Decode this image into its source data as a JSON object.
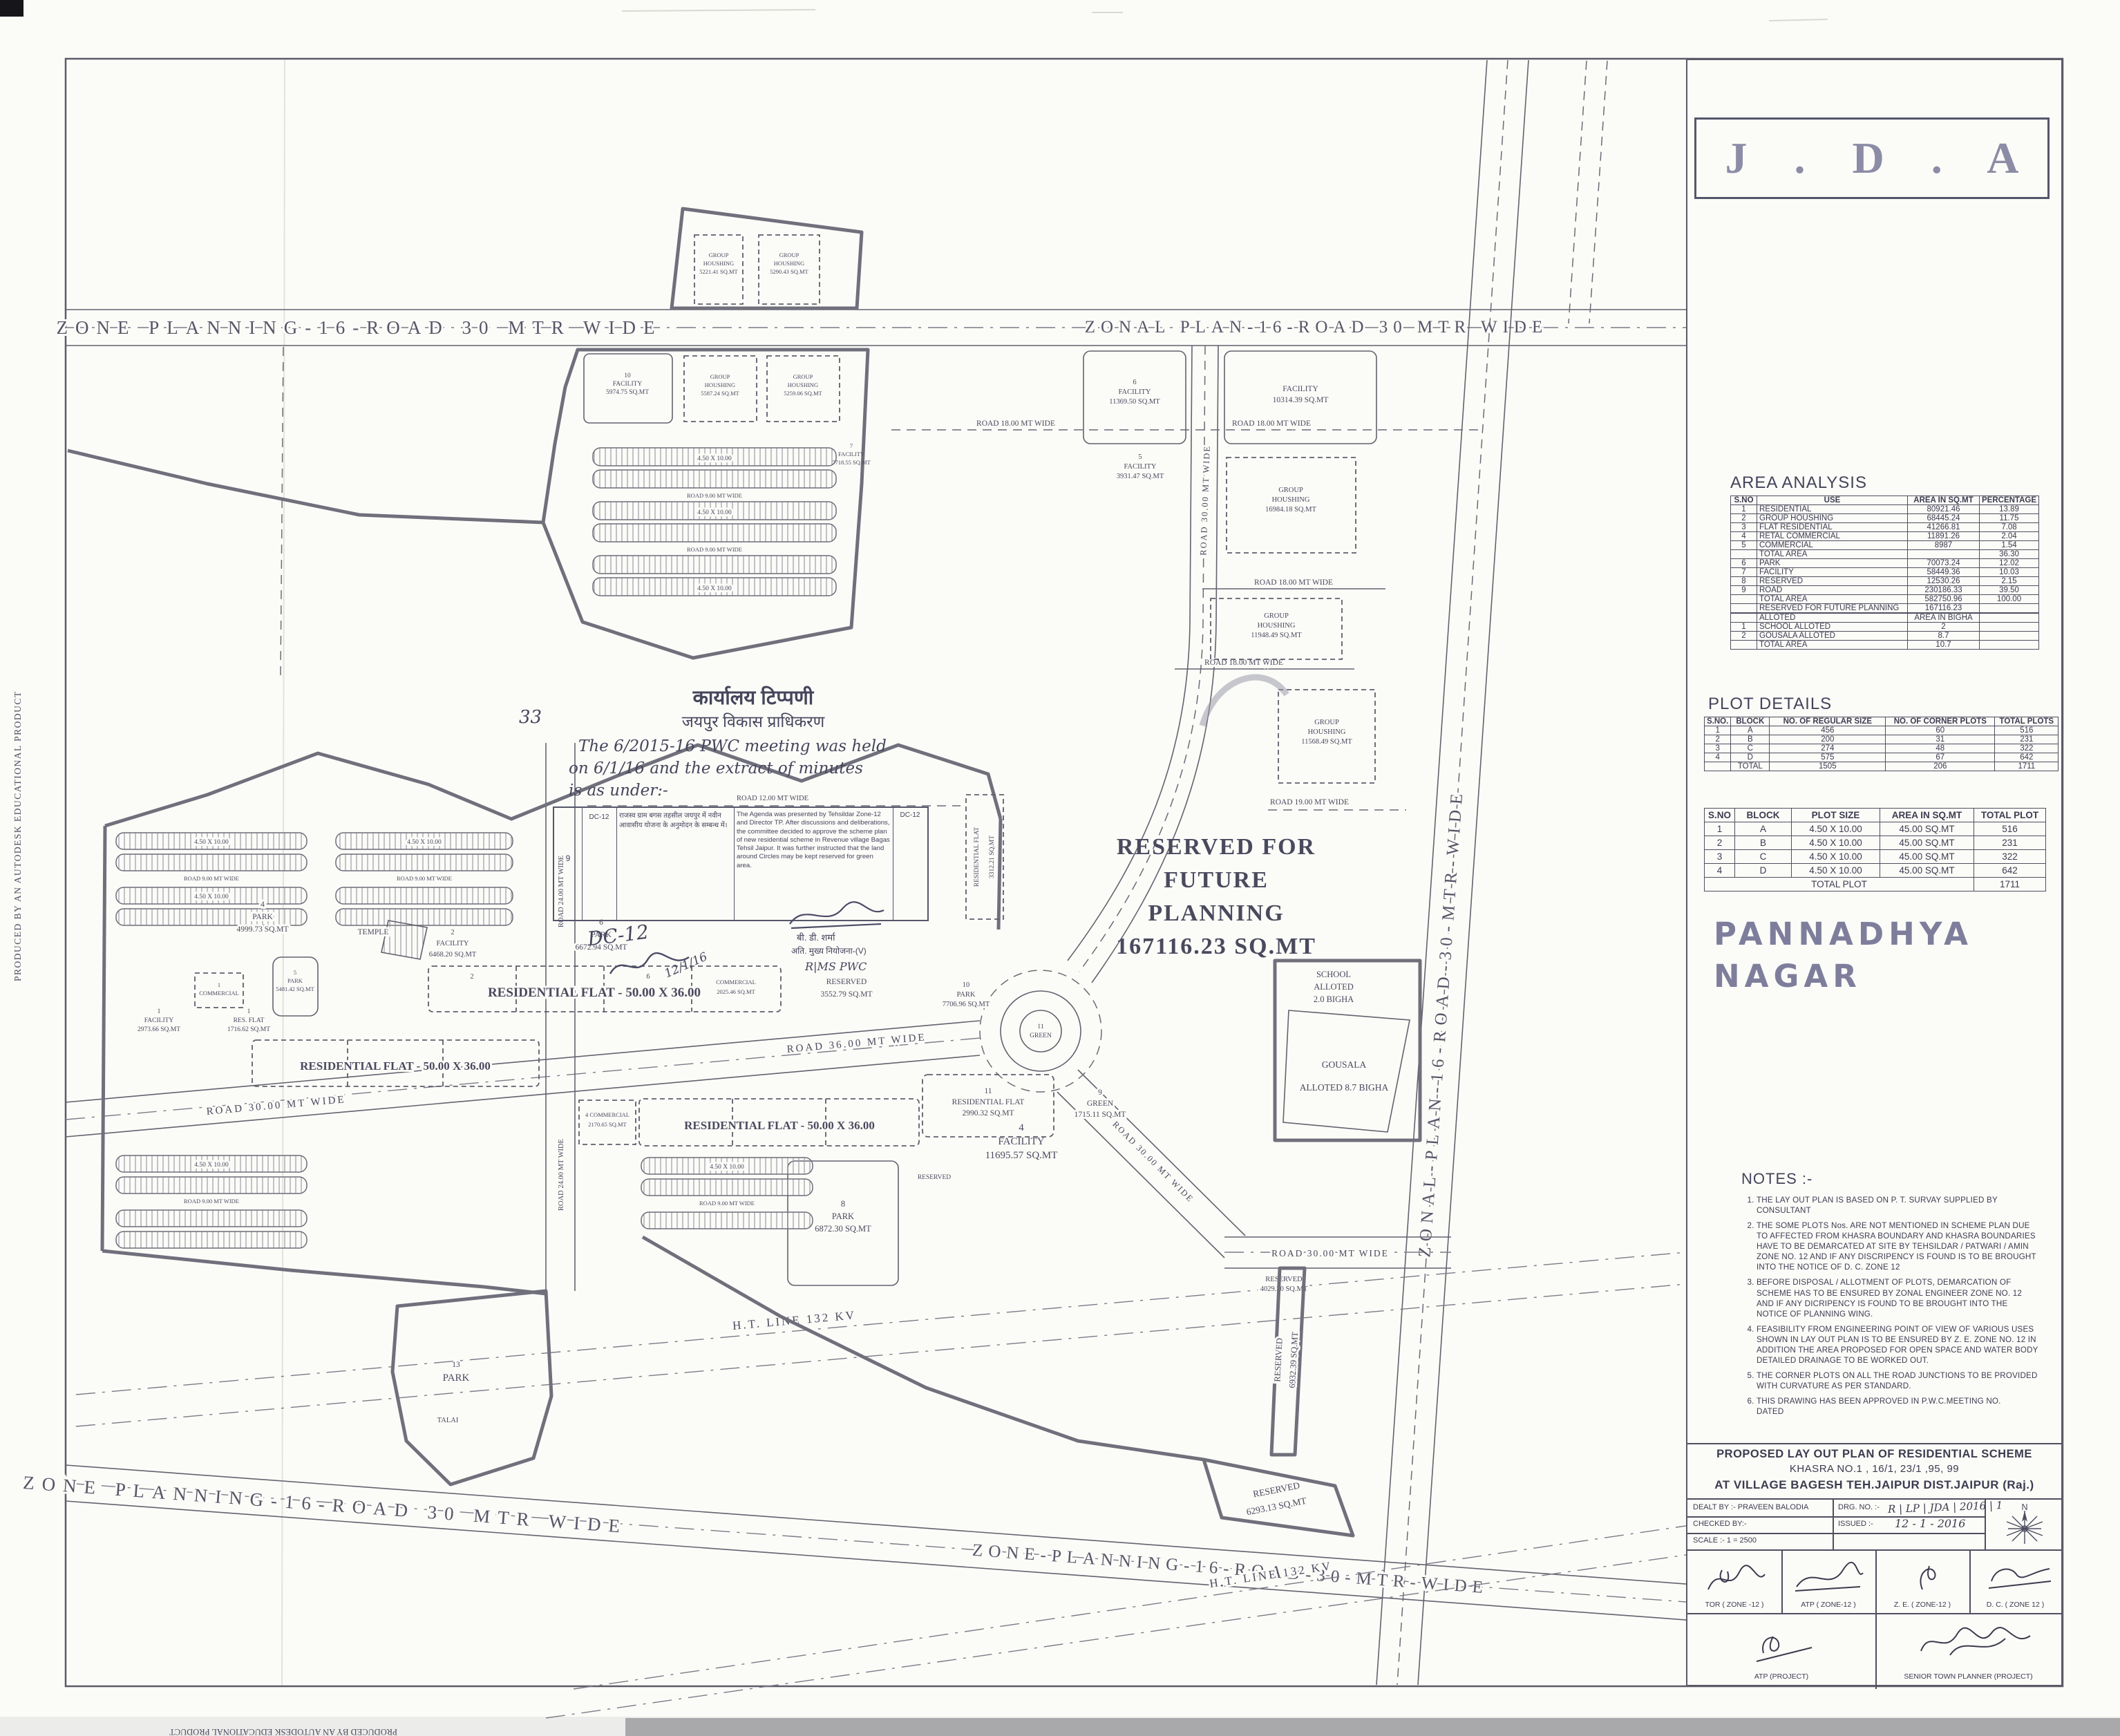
{
  "artifacts": {
    "producer": "PRODUCED BY AN AUTODESK EDUCATIONAL PRODUCT"
  },
  "header": {
    "agency_title": "J . D . A"
  },
  "area_analysis": {
    "title": "AREA ANALYSIS",
    "headers": [
      "S.NO",
      "USE",
      "AREA IN SQ.MT",
      "PERCENTAGE"
    ],
    "rows": [
      [
        "1",
        "RESIDENTIAL",
        "80921.46",
        "13.89"
      ],
      [
        "2",
        "GROUP HOUSHING",
        "68445.24",
        "11.75"
      ],
      [
        "3",
        "FLAT RESIDENTIAL",
        "41266.81",
        "7.08"
      ],
      [
        "4",
        "RETAL COMMERCIAL",
        "11891.26",
        "2.04"
      ],
      [
        "5",
        "COMMERCIAL",
        "8987",
        "1.54"
      ],
      [
        "",
        "TOTAL AREA",
        "",
        "36.30"
      ],
      [
        "6",
        "PARK",
        "70073.24",
        "12.02"
      ],
      [
        "7",
        "FACILITY",
        "58449.36",
        "10.03"
      ],
      [
        "8",
        "RESERVED",
        "12530.26",
        "2.15"
      ],
      [
        "9",
        "ROAD",
        "230186.33",
        "39.50"
      ],
      [
        "",
        "TOTAL AREA",
        "582750.96",
        "100.00"
      ],
      [
        "",
        "RESERVED FOR FUTURE PLANNING",
        "167116.23",
        ""
      ],
      [
        "",
        "",
        "",
        ""
      ],
      [
        "",
        "ALLOTED",
        "AREA IN BIGHA",
        ""
      ],
      [
        "1",
        "SCHOOL ALLOTED",
        "2",
        ""
      ],
      [
        "2",
        "GOUSALA ALLOTED",
        "8.7",
        ""
      ],
      [
        "",
        "TOTAL AREA",
        "10.7",
        ""
      ]
    ]
  },
  "plot_details": {
    "title": "PLOT DETAILS",
    "by_block": {
      "headers": [
        "S.NO.",
        "BLOCK",
        "NO. OF REGULAR SIZE",
        "NO. OF CORNER PLOTS",
        "TOTAL PLOTS"
      ],
      "rows": [
        [
          "1",
          "A",
          "456",
          "60",
          "516"
        ],
        [
          "2",
          "B",
          "200",
          "31",
          "231"
        ],
        [
          "3",
          "C",
          "274",
          "48",
          "322"
        ],
        [
          "4",
          "D",
          "575",
          "67",
          "642"
        ],
        [
          "",
          "TOTAL",
          "1505",
          "206",
          "1711"
        ]
      ]
    },
    "by_size": {
      "headers": [
        "S.NO",
        "BLOCK",
        "PLOT SIZE",
        "AREA IN SQ.MT",
        "TOTAL PLOT"
      ],
      "rows": [
        [
          "1",
          "A",
          "4.50 X 10.00",
          "45.00 SQ.MT",
          "516"
        ],
        [
          "2",
          "B",
          "4.50 X 10.00",
          "45.00 SQ.MT",
          "231"
        ],
        [
          "3",
          "C",
          "4.50 X 10.00",
          "45.00 SQ.MT",
          "322"
        ],
        [
          "4",
          "D",
          "4.50 X 10.00",
          "45.00 SQ.MT",
          "642"
        ]
      ],
      "total_label": "TOTAL PLOT",
      "total_value": "1711"
    }
  },
  "scheme_name": {
    "line1": "PANNADHYA",
    "line2": "NAGAR"
  },
  "notes": {
    "title": "NOTES :-",
    "items": [
      "THE LAY OUT PLAN IS BASED ON  P. T. SURVAY SUPPLIED BY CONSULTANT",
      "THE SOME PLOTS Nos. ARE NOT MENTIONED IN SCHEME PLAN DUE TO AFFECTED FROM KHASRA BOUNDARY AND KHASRA  BOUNDARIES HAVE TO BE DEMARCATED AT SITE BY TEHSILDAR / PATWARI / AMIN ZONE NO. 12  AND IF ANY DISCRIPENCY IS FOUND IS TO BE BROUGHT INTO THE NOTICE OF D. C. ZONE 12",
      "BEFORE DISPOSAL / ALLOTMENT OF PLOTS, DEMARCATION OF SCHEME HAS TO BE ENSURED BY ZONAL  ENGINEER ZONE NO. 12   AND IF ANY DICRIPENCY IS FOUND  TO BE BROUGHT INTO THE NOTICE OF PLANNING WING.",
      "FEASIBILITY FROM ENGINEERING POINT OF VIEW OF VARIOUS USES SHOWN IN  LAY OUT PLAN IS TO BE ENSURED BY  Z. E. ZONE NO. 12  IN ADDITION THE AREA PROPOSED FOR OPEN SPACE AND WATER BODY DETAILED DRAINAGE TO BE WORKED OUT.",
      "THE CORNER PLOTS ON ALL THE ROAD JUNCTIONS TO BE PROVIDED WITH CURVATURE AS PER STANDARD.",
      "THIS DRAWING HAS BEEN APPROVED IN P.W.C.MEETING  NO.                 DATED"
    ]
  },
  "title_block": {
    "scheme_line1": "PROPOSED  LAY OUT PLAN OF RESIDENTIAL SCHEME",
    "scheme_line2": "KHASRA NO.1 , 16/1, 23/1 ,95, 99",
    "scheme_line3": "AT VILLAGE BAGESH TEH.JAIPUR DIST.JAIPUR (Raj.)",
    "dealt_by": "DEALT BY :- PRAVEEN BALODIA",
    "drg_no_label": "DRG. NO. :-",
    "drg_no_value": "R | LP | JDA | 2016 | 1",
    "checked_by": "CHECKED BY:-",
    "issued_label": "ISSUED :-",
    "issued_value": "12 - 1 - 2016",
    "scale": "SCALE :- 1  = 2500",
    "north_letter": "N",
    "sign_row1": [
      "TOR ( ZONE -12 )",
      "ATP ( ZONE-12 )",
      "Z. E. ( ZONE-12 )",
      "D. C. ( ZONE 12 )"
    ],
    "sign_row2": [
      "ATP (PROJECT)",
      "SENIOR TOWN PLANNER (PROJECT)"
    ]
  },
  "office_note": {
    "margin_no": "33",
    "heading_hi": "कार्यालय टिप्पणी",
    "subheading_hi": "जयपुर विकास प्राधिकरण",
    "hand_line1": "The 6/2015-16 PWC meeting was held",
    "hand_line2": "on 6/1/16 and the extract of minutes",
    "hand_line3": "is as under:-",
    "row_no": "9",
    "row_code": "DC-12",
    "agenda_hi": "राजस्व ग्राम बगस तहसील जयपुर में नवीन आवासीय योजना के अनुमोदन के सम्बन्ध में।",
    "minutes_en": "The Agenda was presented by Tehsildar Zone-12 and Director TP. After discussions and deliberations, the committee decided to approve the scheme plan of new residential scheme in Revenue village Bagas Tehsil Jaipur. It was further instructed that the land around Circles may be kept reserved for green area.",
    "code_right": "DC-12",
    "sign_name_hi": "बी. डी. शर्मा",
    "sign_post_hi": "अति. मुख्य नियोजना-(V)",
    "sign_note": "R|MS PWC",
    "hand_code": "DC-12",
    "hand_date": "12/1/16"
  },
  "map": {
    "roads": {
      "top_left": "ZONE PLANNING-16-ROAD 30 MTR WIDE",
      "top_right": "ZONAL PLAN-16-ROAD 30 MTR WIDE",
      "zonal_vertical": "ZONAL-PLAN-16-ROAD-30-MTR-WIDE",
      "bottom_left": "ZONE PLANNING-16-ROAD 30 MTR WIDE",
      "bottom_right": "ZONE-PLANNING-16-ROAD-30-MTR-WIDE",
      "ht_line": "H.T. LINE 132 KV",
      "road_30": "ROAD 30.00 MT WIDE",
      "road_36": "ROAD 36.00 MT WIDE",
      "road_24": "ROAD 24.00 MT WIDE",
      "road_19": "ROAD 19.00 MT WIDE",
      "road_18": "ROAD 18.00 MT WIDE",
      "road_12": "ROAD 12.00 MT WIDE",
      "road_9": "ROAD 9.00 MT WIDE"
    },
    "plot_size": "4.50 X 10.00",
    "cell_2": "2",
    "cell_6": "6",
    "flat_band": "RESIDENTIAL FLAT - 50.00 X 36.00",
    "reserved_word": "RESERVED",
    "talai": "TALAI",
    "reserved_future": [
      "RESERVED FOR",
      "FUTURE",
      "PLANNING",
      "167116.23 SQ.MT"
    ],
    "school": [
      "SCHOOL",
      "ALLOTED",
      "2.0 BIGHA"
    ],
    "gousala": [
      "GOUSALA",
      "ALLOTED 8.7 BIGHA"
    ],
    "roundabout": [
      "11",
      "GREEN"
    ],
    "parcels": {
      "fac_11369": [
        "6",
        "FACILITY",
        "11369.50 SQ.MT"
      ],
      "fac_10314": [
        "FACILITY",
        "10314.39 SQ.MT"
      ],
      "fac_3931": [
        "5",
        "FACILITY",
        "3931.47 SQ.MT"
      ],
      "fac_5974": [
        "10",
        "FACILITY",
        "5974.75 SQ.MT"
      ],
      "fac_7718": [
        "7",
        "FACILITY",
        "7718.55 SQ.MT"
      ],
      "fac_11695": [
        "4",
        "FACILITY",
        "11695.57 SQ.MT"
      ],
      "fac_6468": [
        "2",
        "FACILITY",
        "6468.20 SQ.MT"
      ],
      "fac_2973": [
        "1",
        "FACILITY",
        "2973.66 SQ.MT"
      ],
      "gh_5221": [
        "GROUP",
        "HOUSHING",
        "5221.41 SQ.MT"
      ],
      "gh_5290": [
        "GROUP",
        "HOUSHING",
        "5290.43 SQ.MT"
      ],
      "gh_5587": [
        "GROUP",
        "HOUSHING",
        "5587.24 SQ.MT"
      ],
      "gh_5259": [
        "GROUP",
        "HOUSHING",
        "5259.06 SQ.MT"
      ],
      "gh_16984": [
        "GROUP",
        "HOUSHING",
        "16984.18 SQ.MT"
      ],
      "gh_11948": [
        "GROUP",
        "HOUSHING",
        "11948.49 SQ.MT"
      ],
      "gh_11568": [
        "GROUP",
        "HOUSHING",
        "11568.49 SQ.MT"
      ],
      "park_7706": [
        "10",
        "PARK",
        "7706.96 SQ.MT"
      ],
      "park_6672": [
        "6",
        "PARK",
        "6672.94 SQ.MT"
      ],
      "park_4999": [
        "4",
        "PARK",
        "4999.73 SQ.MT"
      ],
      "park_5481": [
        "5",
        "PARK",
        "5481.42 SQ.MT"
      ],
      "park_6872": [
        "8",
        "PARK",
        "6872.30 SQ.MT"
      ],
      "park_13": [
        "13",
        "PARK"
      ],
      "green_1715": [
        "9",
        "GREEN",
        "1715.11 SQ.MT"
      ],
      "res_3552": [
        "RESERVED",
        "3552.79 SQ.MT"
      ],
      "res_4029": [
        "RESERVED",
        "4029.30 SQ.MT"
      ],
      "res_6932": [
        "RESERVED",
        "6932.39 SQ.MT"
      ],
      "res_6293": [
        "RESERVED",
        "6293.13 SQ.MT"
      ],
      "temple": "TEMPLE",
      "resflat_1716": [
        "1",
        "RES. FLAT",
        "1716.62 SQ.MT"
      ],
      "resflat_2990": [
        "11",
        "RESIDENTIAL FLAT",
        "2990.32 SQ.MT"
      ],
      "resflat_3312": [
        "RESIDENTIAL FLAT",
        "3312.21 SQ.MT"
      ],
      "comm_1": [
        "1",
        "COMMERCIAL"
      ],
      "comm_2170": [
        "4 COMMERCIAL",
        "2170.65 SQ.MT"
      ],
      "comm_2025": [
        "COMMERCIAL",
        "2025.46 SQ.MT"
      ]
    }
  }
}
